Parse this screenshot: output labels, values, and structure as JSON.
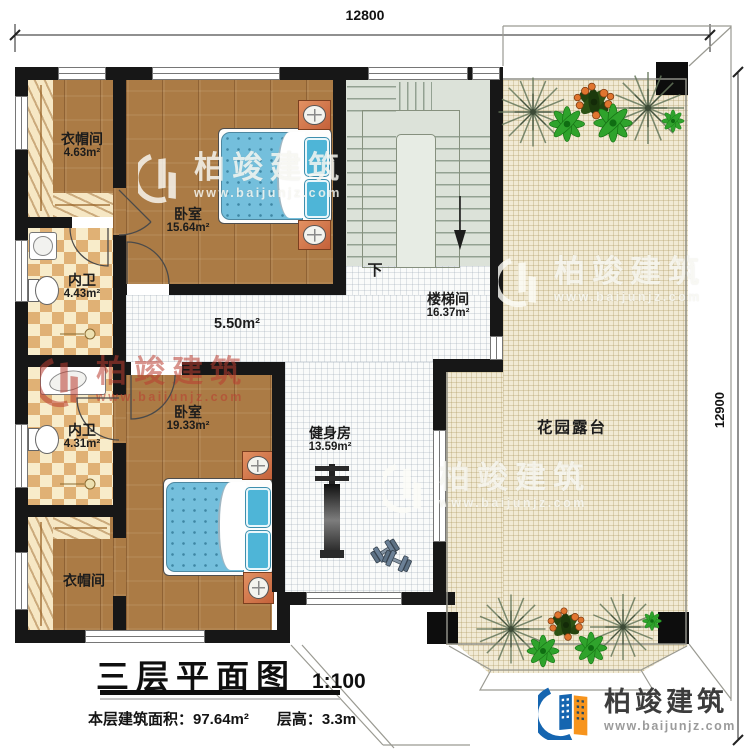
{
  "dimensions": {
    "top": "12800",
    "right": "12900"
  },
  "rooms": {
    "closet_top": {
      "name": "衣帽间",
      "area": "4.63m²"
    },
    "bedroom_top": {
      "name": "卧室",
      "area": "15.64m²"
    },
    "bath_top": {
      "name": "内卫",
      "area": "4.43m²"
    },
    "stairwell": {
      "name": "楼梯间",
      "area": "16.37m²"
    },
    "hallway": {
      "area": "5.50m²"
    },
    "bath_bottom": {
      "name": "内卫",
      "area": "4.31m²"
    },
    "bedroom_bottom": {
      "name": "卧室",
      "area": "19.33m²"
    },
    "closet_bottom": {
      "name": "衣帽间"
    },
    "gym": {
      "name": "健身房",
      "area": "13.59m²"
    },
    "terrace": {
      "name": "花园露台"
    }
  },
  "stairs": {
    "down_label": "下"
  },
  "title_block": {
    "title": "三层平面图",
    "scale": "1:100",
    "floor_area": "本层建筑面积：97.64m²",
    "floor_height": "层高：3.3m"
  },
  "watermark": {
    "brand": "柏竣建筑",
    "url": "www.baijunjz.com"
  },
  "logo": {
    "brand": "柏竣建筑",
    "url": "www.baijunjz.com"
  },
  "colors": {
    "wall": "#171717",
    "wood": "#ab7b45",
    "terrace": "#f1ead5",
    "mattress_blue": "#74bfdc",
    "nightstand_orange": "#d97f50",
    "logo_blue": "#1565b0",
    "logo_orange": "#f7941d",
    "watermark_red": "#ba3c2f"
  }
}
